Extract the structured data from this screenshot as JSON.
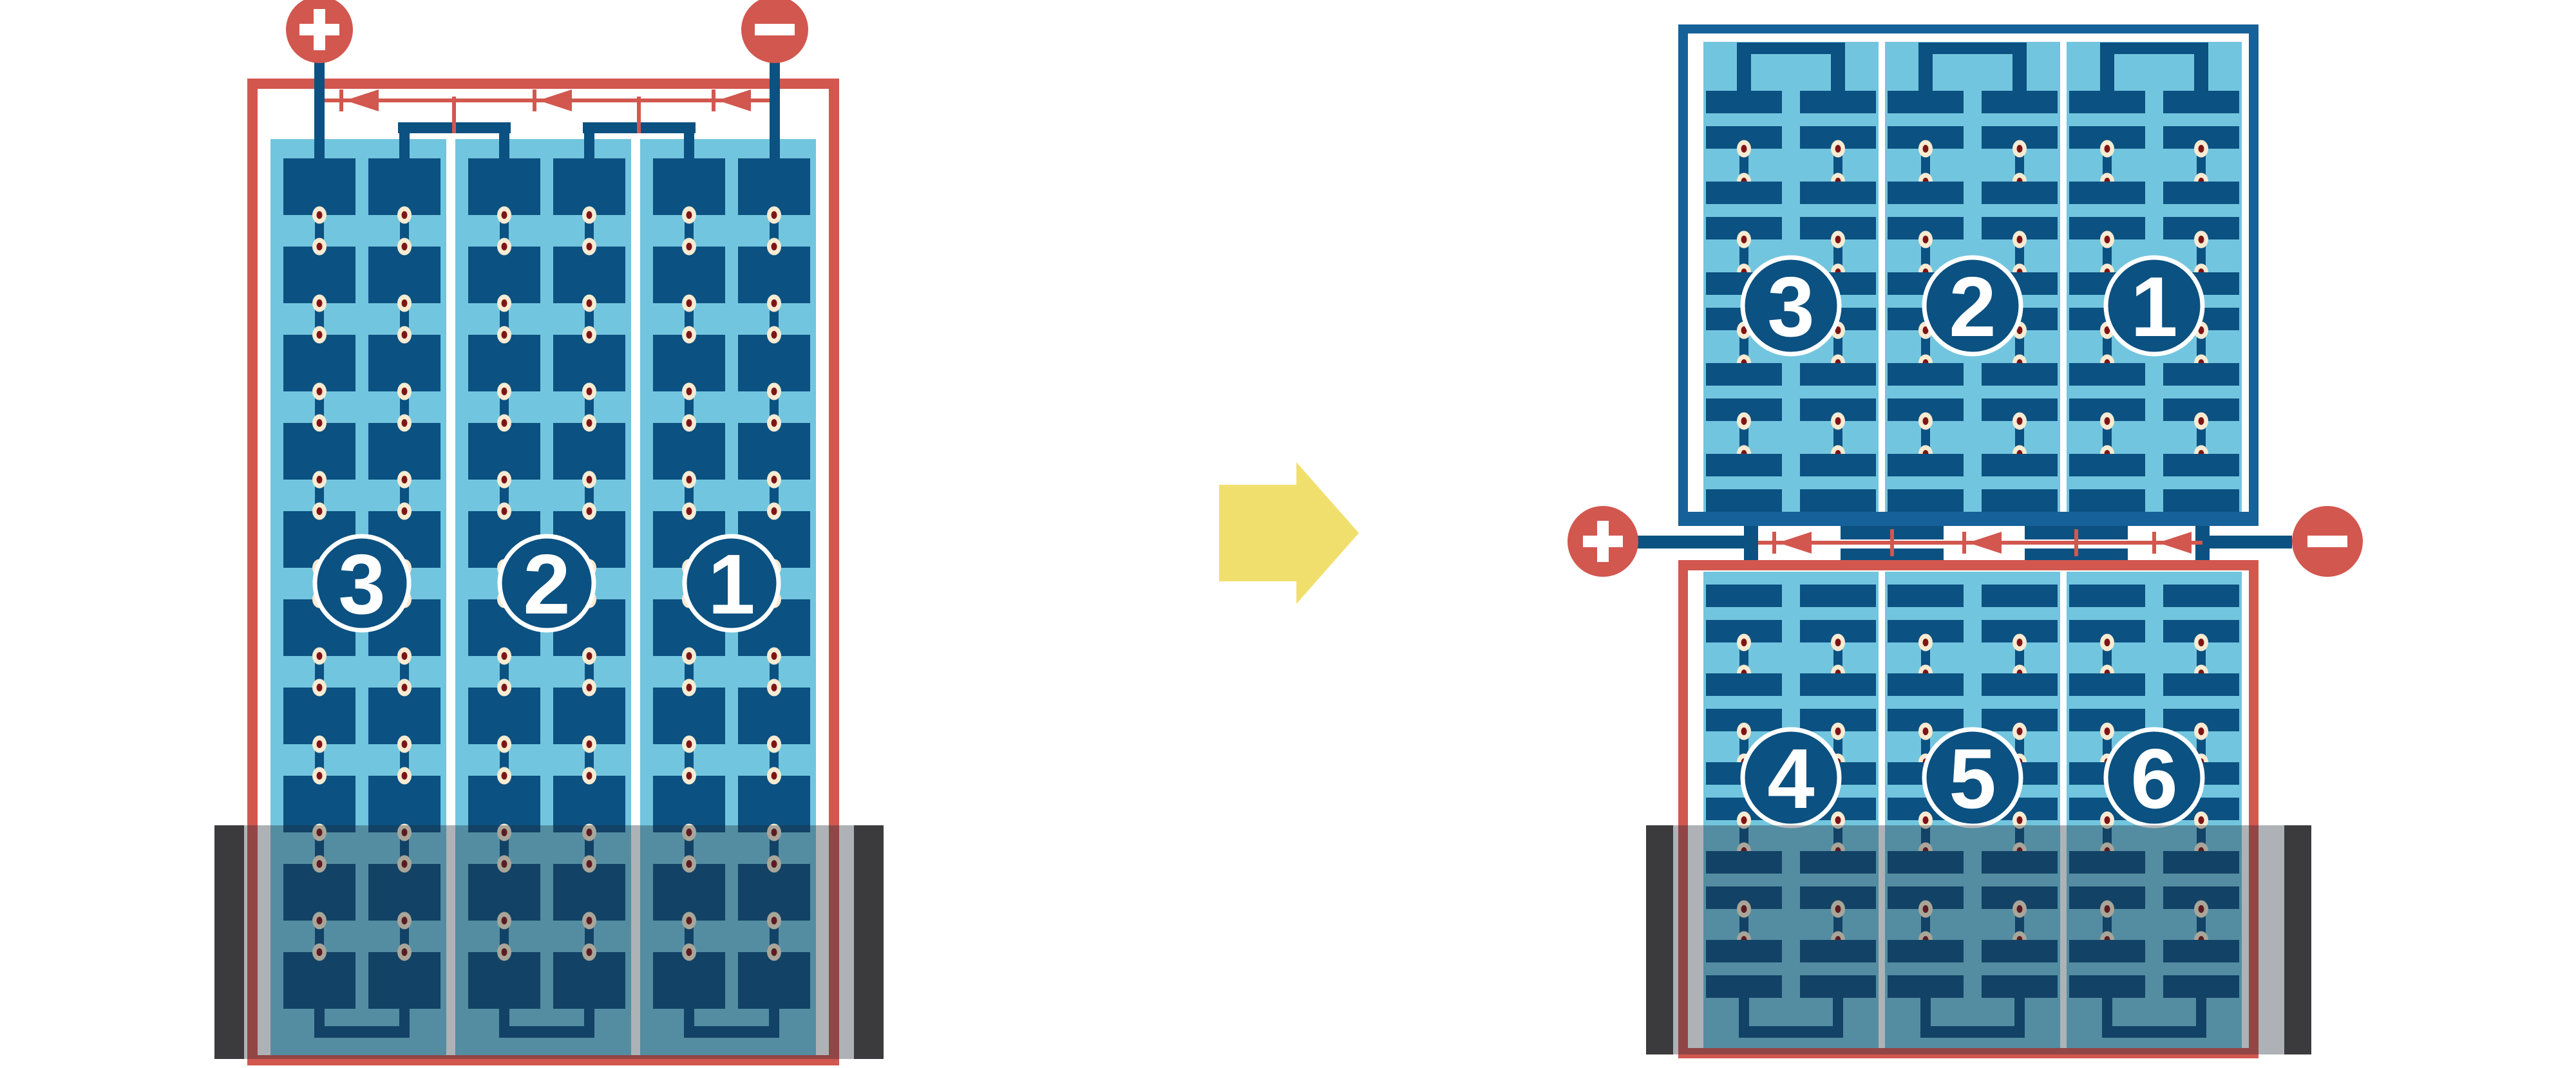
{
  "diagram_title": "",
  "colors": {
    "background": "#FFFFFF",
    "red": "#D2574F",
    "dark_blue": "#0B5181",
    "frame_blue": "#17619A",
    "light_blue": "#72C5DE",
    "cream": "#F7EBD2",
    "solder_dot": "#7E1416",
    "shadow_overlay": "rgba(30,42,52,0.36)",
    "shadow_edge": "#3B3B3D",
    "arrow_yellow": "#F1DF6D",
    "white": "#FFFFFF"
  },
  "left_module": {
    "terminals": {
      "positive": "+",
      "negative": "−"
    },
    "strings": [
      {
        "label": "3"
      },
      {
        "label": "2"
      },
      {
        "label": "1"
      }
    ],
    "bypass_diode_count": 3
  },
  "arrow": {
    "direction": "right"
  },
  "right_module": {
    "terminals": {
      "positive": "+",
      "negative": "−"
    },
    "top_half": {
      "strings": [
        {
          "label": "3"
        },
        {
          "label": "2"
        },
        {
          "label": "1"
        }
      ]
    },
    "bottom_half": {
      "strings": [
        {
          "label": "4"
        },
        {
          "label": "5"
        },
        {
          "label": "6"
        }
      ]
    },
    "bypass_diode_count": 3
  }
}
